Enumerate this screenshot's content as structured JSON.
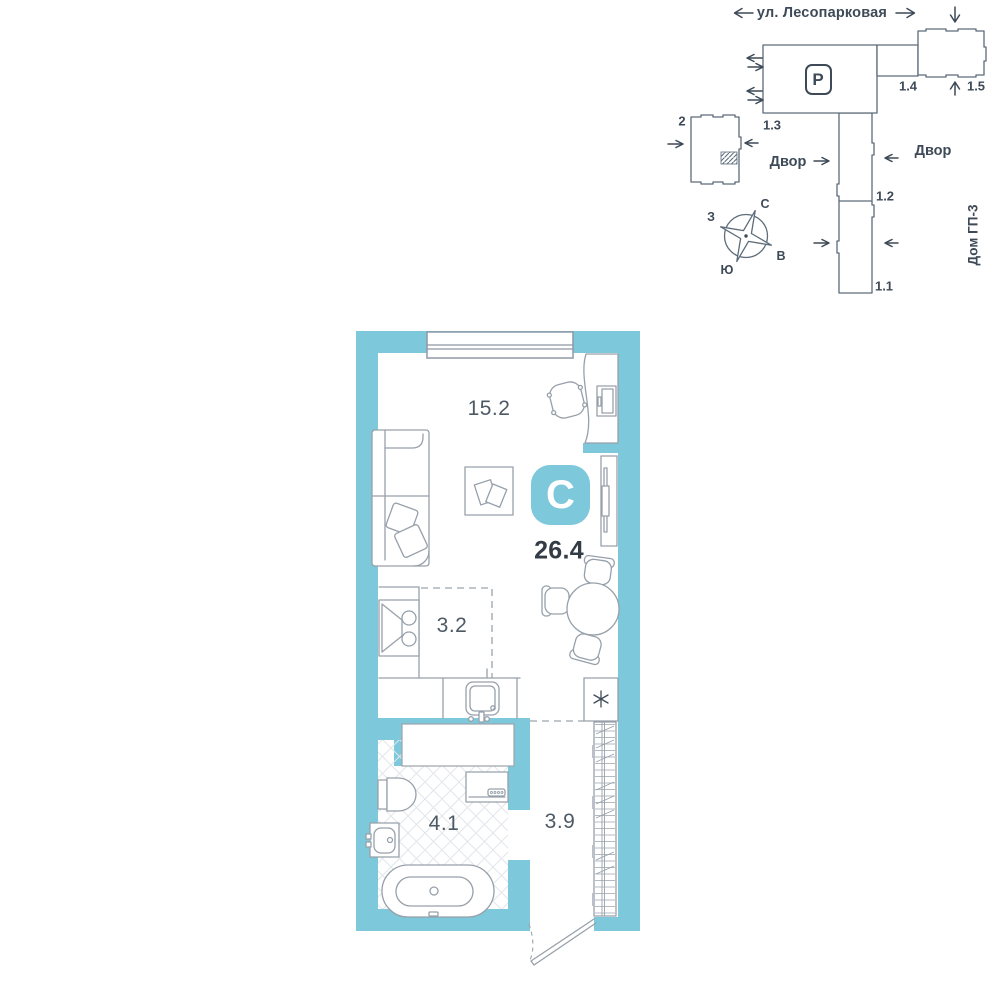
{
  "colors": {
    "wall_teal": "#7dc8da",
    "line_gray": "#97a0aa",
    "site_line": "#5d6b7a",
    "text_dark": "#3e4a57",
    "area_text": "#4d5965",
    "total_text": "#333c46"
  },
  "site_plan": {
    "street": "ул. Лесопарковая",
    "parking_sign": "P",
    "labels": {
      "b2": "2",
      "b11": "1.1",
      "b12": "1.2",
      "b13": "1.3",
      "b14": "1.4",
      "b15": "1.5"
    },
    "yard_left": "Двор",
    "yard_right": "Двор",
    "house": "Дом ГП-3",
    "compass": {
      "n": "С",
      "s": "Ю",
      "w": "З",
      "e": "В"
    }
  },
  "floor_plan": {
    "badge": "С",
    "total_area": "26.4",
    "areas": {
      "living": "15.2",
      "kitchen": "3.2",
      "bathroom": "4.1",
      "hall": "3.9"
    },
    "fridge_symbol": "✳"
  }
}
